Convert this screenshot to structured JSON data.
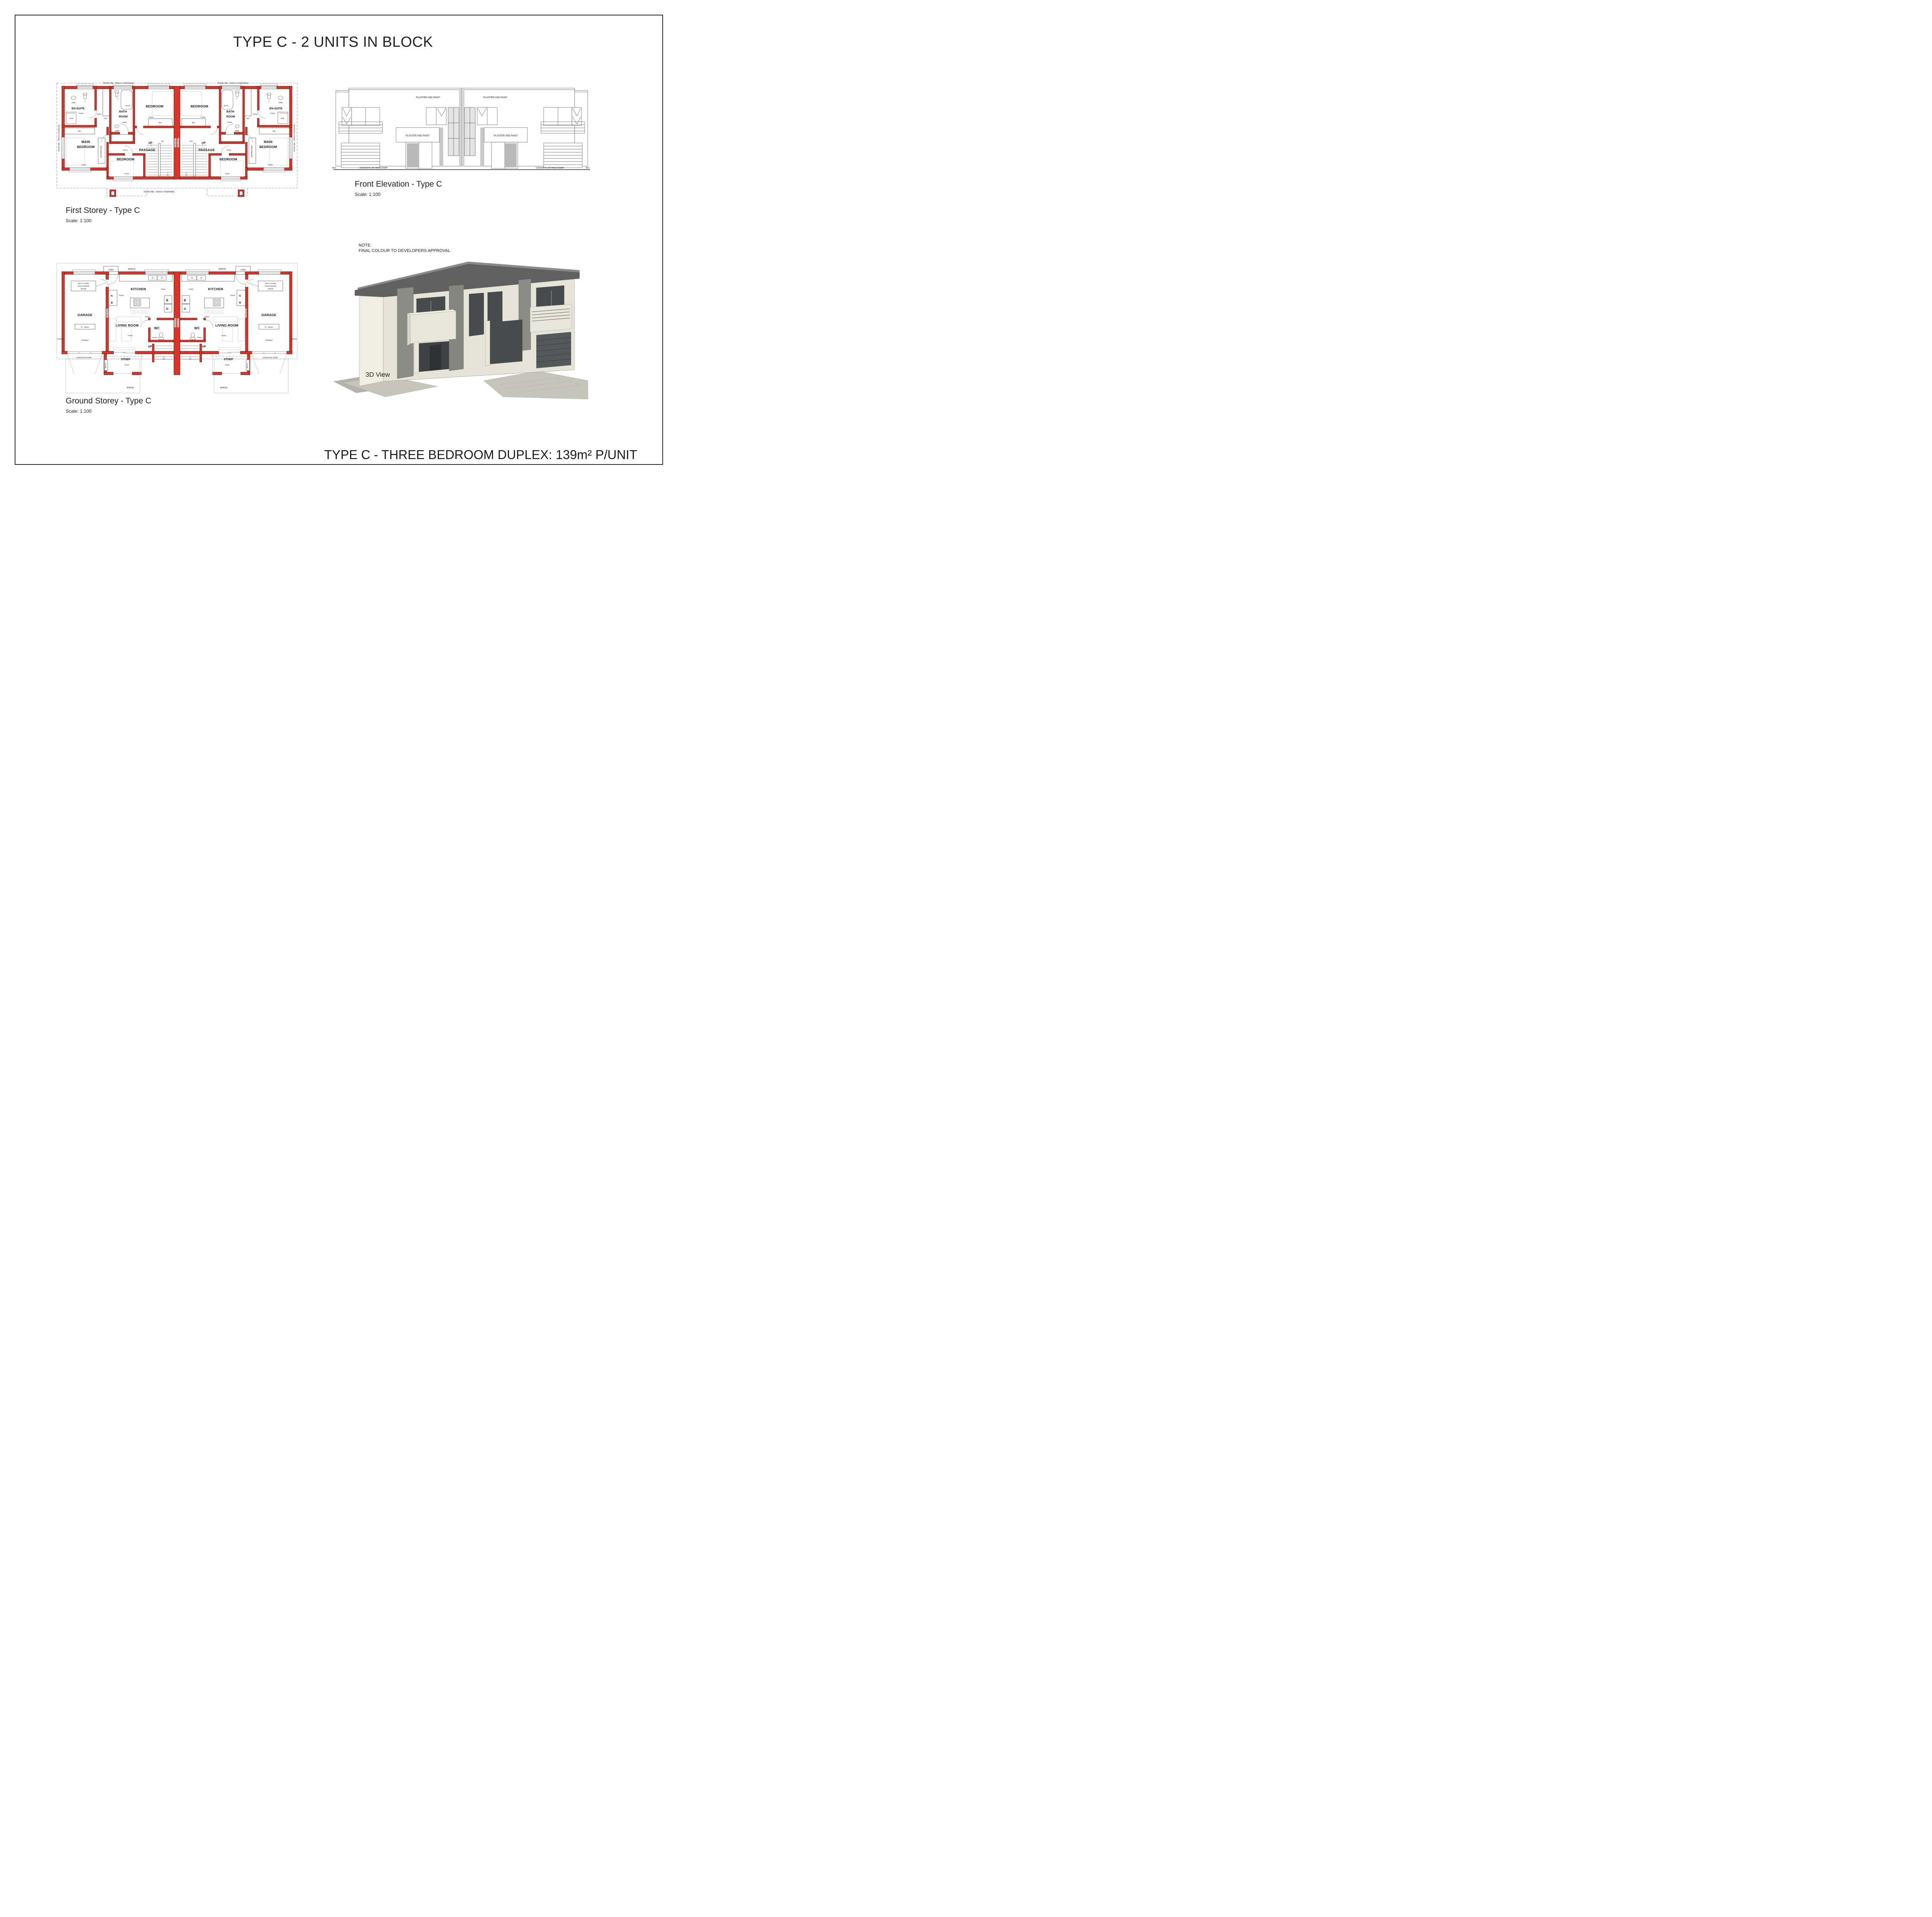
{
  "sheet": {
    "title": "TYPE C - 2 UNITS IN BLOCK",
    "footer_title": "TYPE C - THREE BEDROOM DUPLEX: 139m² P/UNIT"
  },
  "colors": {
    "wall_red": "#e2382c",
    "wall_hatch": "#a32417",
    "line": "#1c1c1c",
    "facade_cream": "#e6e4d6",
    "roof_dark": "#606060",
    "accent_gray": "#85857f",
    "paving_gray": "#c6c5bb"
  },
  "first_storey": {
    "caption": "First Storey - Type C",
    "scale": "Scale: 1:100",
    "labels": {
      "roofline_600": "ROOFLINE - 600mm OVERHANG",
      "roofline_300": "ROOFLINE - 300mm OVERHANG",
      "en_suite": "EN-SUITE",
      "tiles": "TILES",
      "hwb": "HWB",
      "t": "T",
      "shr": "SHR",
      "bic": "BIC",
      "bath": "BATH",
      "bath_room_1": "BATH-",
      "bath_room_2": "ROOM",
      "bedroom": "BEDROOM",
      "main_1": "MAIN",
      "main_2": "BEDROOM",
      "bic_dresser": "BIC/DRESSER",
      "passage": "PASSAGE",
      "up": "UP",
      "firewall": "FIREWALL"
    }
  },
  "ground_storey": {
    "caption": "Ground Storey - Type C",
    "scale": "Scale: 1:100",
    "labels": {
      "apron": "APRON",
      "step": "STEP",
      "kitchen": "KITCHEN",
      "tiles": "TILES",
      "self_close_1": "SELF CLOSE",
      "self_close_2": "SOLID WOOD",
      "self_close_3": "DOOR",
      "r": "R",
      "f": "F",
      "w": "W",
      "d": "D",
      "garage": "GARAGE",
      "fl": "FL: -85mm",
      "screed": "SCREED",
      "living_room": "LIVING ROOM",
      "wc": "WC",
      "up": "UP",
      "firewall": "FIREWALL",
      "stoep": "STOEP",
      "braai": "BRAAI",
      "concrete_ramp": "CONCRETE RAMP"
    }
  },
  "elevation": {
    "caption": "Front Elevation - Type C",
    "scale": "Scale: 1:100",
    "labels": {
      "plaster": "PLASTER AND PAINT",
      "ramp": "CONCRETE OR PAVED RAMP",
      "ngl": "NGL"
    }
  },
  "view3d": {
    "caption": "3D View",
    "note1": "NOTE:",
    "note2": "FINAL COLOUR TO DEVELOPERS APPROVAL"
  }
}
